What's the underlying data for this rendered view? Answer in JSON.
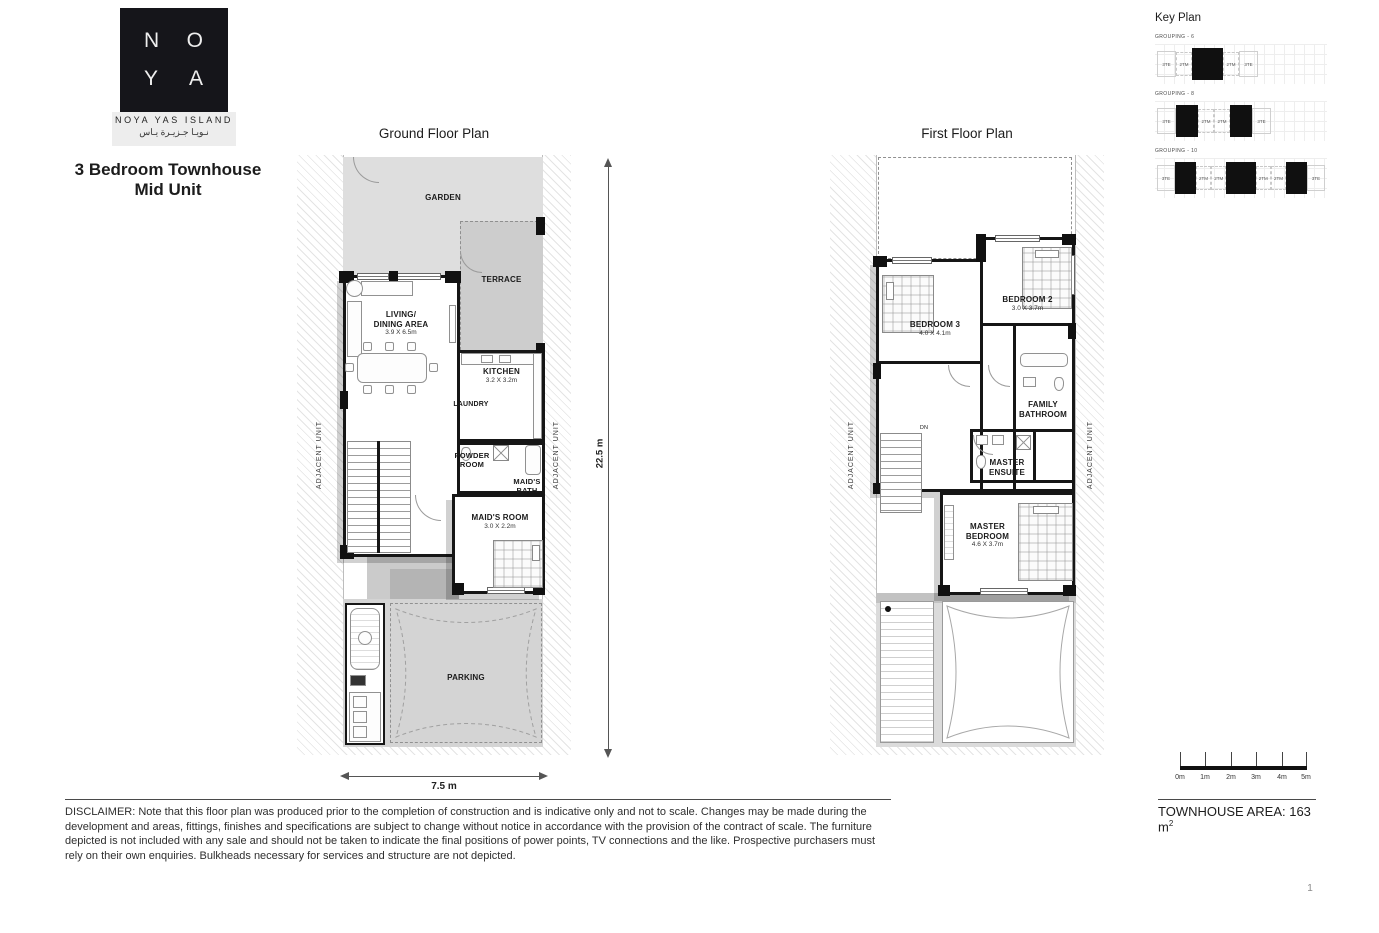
{
  "logo": {
    "letters": {
      "n": "N",
      "o": "O",
      "y": "Y",
      "a": "A"
    },
    "name": "NOYA YAS ISLAND",
    "arabic": "نـويـا جـزيـرة يـاس"
  },
  "title": {
    "line1": "3 Bedroom Townhouse",
    "line2": "Mid Unit"
  },
  "plans": {
    "ground": {
      "title": "Ground Floor Plan",
      "garden": "GARDEN",
      "terrace": "TERRACE",
      "living": {
        "l1": "LIVING/",
        "l2": "DINING AREA",
        "dim": "3.9 X 6.5m"
      },
      "kitchen": {
        "name": "KITCHEN",
        "dim": "3.2 X 3.2m"
      },
      "laundry": "LAUNDRY",
      "powder": {
        "l1": "POWDER",
        "l2": "ROOM"
      },
      "maids_bath": {
        "l1": "MAID'S",
        "l2": "BATH"
      },
      "maids_room": {
        "name": "MAID'S ROOM",
        "dim": "3.0 X 2.2m"
      },
      "parking": "PARKING",
      "adjacent": "ADJACENT UNIT"
    },
    "first": {
      "title": "First Floor Plan",
      "bedroom3": {
        "name": "BEDROOM 3",
        "dim": "4.0 X 4.1m"
      },
      "bedroom2": {
        "name": "BEDROOM 2",
        "dim": "3.0 X 3.7m"
      },
      "family_bath": {
        "l1": "FAMILY",
        "l2": "BATHROOM"
      },
      "ensuite": {
        "l1": "MASTER",
        "l2": "ENSUITE"
      },
      "master": {
        "l1": "MASTER",
        "l2": "BEDROOM",
        "dim": "4.6 X 3.7m"
      },
      "stair": "DN",
      "adjacent": "ADJACENT UNIT"
    }
  },
  "dimensions": {
    "vertical": "22.5 m",
    "horizontal": "7.5 m"
  },
  "key_plan": {
    "title": "Key Plan",
    "groupings": [
      {
        "label": "GROUPING - 6",
        "cells": [
          {
            "t": "3TE",
            "k": "e"
          },
          {
            "t": "2TM",
            "k": "m"
          },
          {
            "t": "",
            "k": "fw"
          },
          {
            "t": "2TM",
            "k": "m"
          },
          {
            "t": "3TE",
            "k": "e"
          }
        ]
      },
      {
        "label": "GROUPING - 8",
        "cells": [
          {
            "t": "3TE",
            "k": "e"
          },
          {
            "t": "",
            "k": "f"
          },
          {
            "t": "2TM",
            "k": "m"
          },
          {
            "t": "2TM",
            "k": "m"
          },
          {
            "t": "",
            "k": "f"
          },
          {
            "t": "3TE",
            "k": "e"
          }
        ]
      },
      {
        "label": "GROUPING - 10",
        "cells": [
          {
            "t": "3TE",
            "k": "e"
          },
          {
            "t": "",
            "k": "f"
          },
          {
            "t": "2TM",
            "k": "m"
          },
          {
            "t": "2TM",
            "k": "m"
          },
          {
            "t": "",
            "k": "fw"
          },
          {
            "t": "2TM",
            "k": "m"
          },
          {
            "t": "2TM",
            "k": "m"
          },
          {
            "t": "",
            "k": "f"
          },
          {
            "t": "3TE",
            "k": "e"
          }
        ]
      }
    ]
  },
  "scale_bar": {
    "labels": [
      "0m",
      "1m",
      "2m",
      "3m",
      "4m",
      "5m"
    ]
  },
  "area": {
    "label": "TOWNHOUSE AREA: 163 m",
    "sup": "2"
  },
  "disclaimer": "DISCLAIMER: Note that this floor plan was produced prior to the completion of construction and is indicative only and not to scale. Changes may be made during the development and areas, fittings, finishes and specifications are subject to change without notice in accordance with the provision of the contract of scale. The furniture depicted is not included with any sale and should not be taken to indicate the final positions of power points, TV connections and the like. Prospective purchasers must rely on their own enquiries. Bulkheads necessary for services and structure are not depicted.",
  "page_number": "1"
}
